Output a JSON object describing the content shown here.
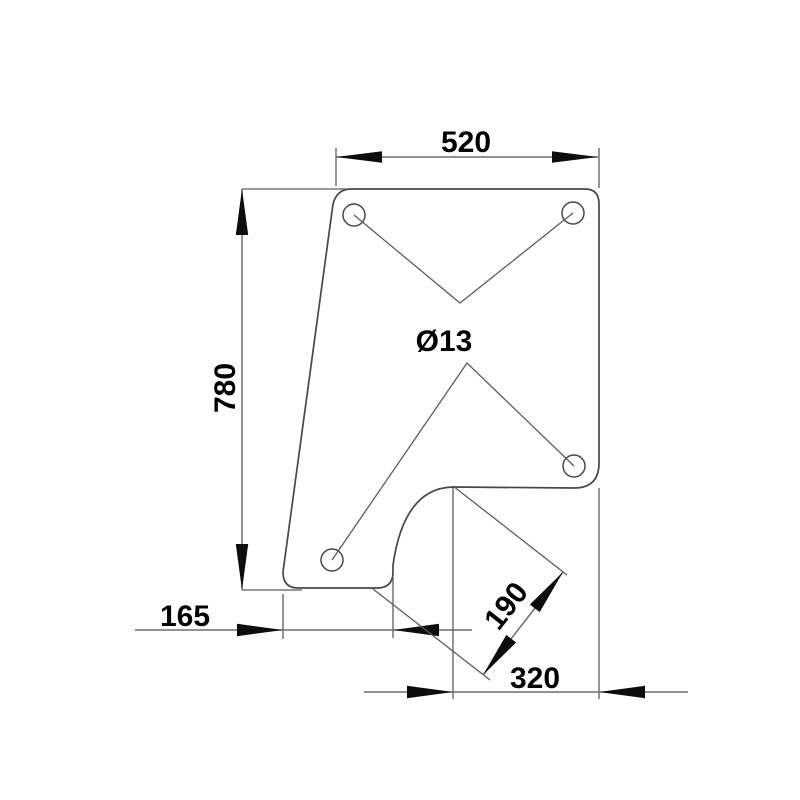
{
  "drawing": {
    "kind": "technical-dimension-drawing",
    "part": "mounting-bracket-plate",
    "labels": {
      "width_top": "520",
      "height_left": "780",
      "offset_bottom_left": "165",
      "notch_diagonal": "190",
      "width_bottom_right": "320",
      "hole_diameter": "Ø13"
    },
    "holes_count": 4,
    "colors": {
      "background": "#ffffff",
      "outline": "#474747",
      "dimension_line": "#6d6d6d",
      "extension_line": "#5c5c5c",
      "arrow": "#0d0d0d",
      "text": "#000000"
    }
  }
}
